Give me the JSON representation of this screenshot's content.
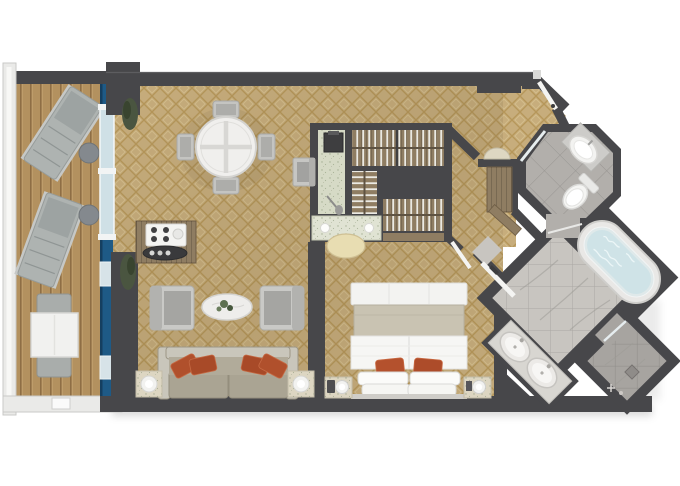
{
  "image": {
    "type": "floor-plan",
    "subject": "Top-down rendered floor plan of a suite with balcony, living room, walk-in closet, bedroom and bathrooms",
    "orientation": "top-down"
  },
  "palette": {
    "wall": "#47474a",
    "carpet": "#c7ad7c",
    "carpet-gold": "#a8853e",
    "deck": "#b3915f",
    "hull": "#1e5a86",
    "glass": "#cfe0e6",
    "rail": "#eaeae8",
    "marble-bright": "#c8c5c0",
    "marble-mid": "#b2afab",
    "marble-dark": "#a7a4a0",
    "speckle": "#d6dac6",
    "wood": "#8f7d62",
    "wood-dark": "#6d5c44",
    "sofa": "#aaa493",
    "sofa-frame": "#c9c6bb",
    "chair": "#c4c4c1",
    "pillow": "#b0502c",
    "bed-white": "#f6f6f4",
    "blanket": "#c9c3b2",
    "stool": "#e8ddb2",
    "lamp": "#f2f2f0",
    "fixture": "#f3f3f1",
    "tub-water": "#cfe3e7",
    "plant": "#4a5540"
  },
  "rooms": [
    {
      "id": "balcony",
      "name": "Private balcony",
      "furniture": [
        "sun lounger",
        "sun lounger",
        "round side table",
        "round side table",
        "square table",
        "chair",
        "chair"
      ]
    },
    {
      "id": "living-room",
      "name": "Living room",
      "furniture": [
        "round dining table",
        "4 dining chairs",
        "bar cabinet with tray",
        "2 armchairs",
        "oval coffee table",
        "sofa with 4 accent pillows",
        "2 lamp side tables",
        "2 planters",
        "desk chair"
      ]
    },
    {
      "id": "walk-in-closet",
      "name": "Walk-in closet",
      "furniture": [
        "safe",
        "3 hanging wardrobes",
        "vanity counter",
        "vanity stool",
        "bench"
      ]
    },
    {
      "id": "entry-hall",
      "name": "Entry hall",
      "furniture": [
        "entry door",
        "half-round console",
        "tall cabinet",
        "angled shelf"
      ]
    },
    {
      "id": "bedroom",
      "name": "Bedroom",
      "furniture": [
        "king bed",
        "2 orange pillows",
        "2 nightstands with lamps"
      ]
    },
    {
      "id": "water-closet",
      "name": "Water closet",
      "furniture": [
        "corner sink",
        "toilet",
        "glass door"
      ]
    },
    {
      "id": "bathroom",
      "name": "Master bathroom",
      "furniture": [
        "oval bathtub",
        "double-sink vanity",
        "walk-in shower with drain",
        "glass shower door"
      ]
    }
  ]
}
